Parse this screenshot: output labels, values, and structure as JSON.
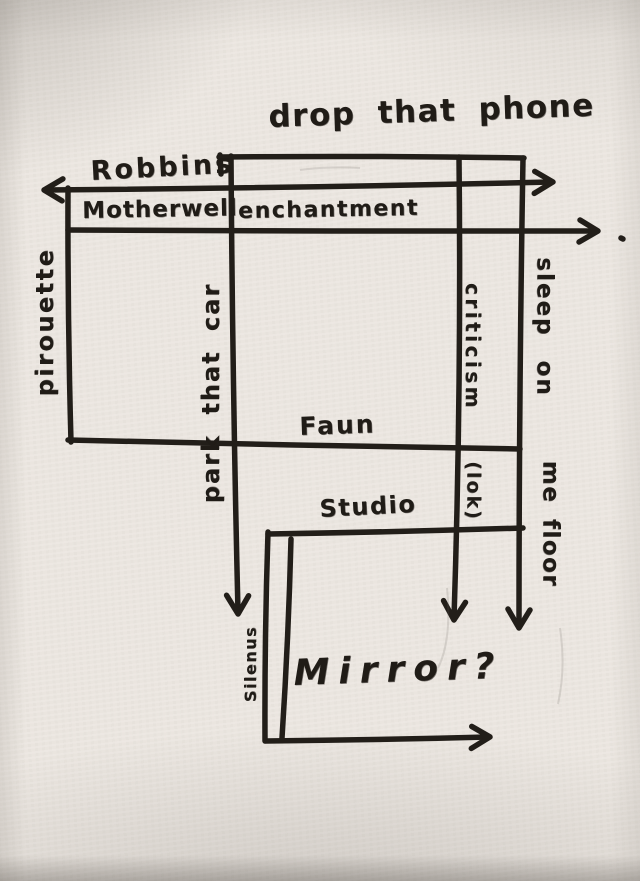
{
  "colors": {
    "paper": "#eae5df",
    "ink": "#221e19"
  },
  "diagram": {
    "labels": [
      {
        "name": "drop-that-phone",
        "text": "drop that phone",
        "x": 268,
        "y": 102,
        "size": 31,
        "rotate": -2,
        "spacing": 1.5,
        "word": 10
      },
      {
        "name": "robbins",
        "text": "Robbins",
        "x": 90,
        "y": 158,
        "size": 27,
        "rotate": -3,
        "spacing": 3,
        "word": 0
      },
      {
        "name": "motherwell",
        "text": "Motherwell",
        "x": 82,
        "y": 200,
        "size": 23,
        "rotate": -1,
        "spacing": 1,
        "word": 0
      },
      {
        "name": "enchantment",
        "text": "enchantment",
        "x": 238,
        "y": 201,
        "size": 22,
        "rotate": -1,
        "spacing": 1.5,
        "word": 0
      },
      {
        "name": "faun",
        "text": "Faun",
        "x": 299,
        "y": 414,
        "size": 25,
        "rotate": -2,
        "spacing": 2,
        "word": 0
      },
      {
        "name": "studio",
        "text": "Studio",
        "x": 319,
        "y": 497,
        "size": 24,
        "rotate": -3,
        "spacing": 1.5,
        "word": 0
      },
      {
        "name": "mirror",
        "text": "Mirror?",
        "x": 293,
        "y": 656,
        "size": 36,
        "rotate": -2,
        "spacing": 9,
        "word": 0,
        "italic": true
      },
      {
        "name": "pirouette",
        "text": "pirouette",
        "cx": 45,
        "cy": 322,
        "size": 24,
        "vertical": "up",
        "spacing": 2.5,
        "word": 0
      },
      {
        "name": "park-that-car",
        "text": "park that car",
        "cx": 211,
        "cy": 393,
        "size": 24,
        "vertical": "up",
        "spacing": 2,
        "word": 9
      },
      {
        "name": "criticism",
        "text": "criticism",
        "cx": 473,
        "cy": 347,
        "size": 20,
        "vertical": "down",
        "spacing": 3.5,
        "word": 0
      },
      {
        "name": "sleep-on",
        "text": "sleep on",
        "cx": 544,
        "cy": 327,
        "size": 23,
        "vertical": "down",
        "spacing": 2,
        "word": 14
      },
      {
        "name": "me-floor",
        "text": "me floor",
        "cx": 550,
        "cy": 524,
        "size": 23,
        "vertical": "down",
        "spacing": 1.5,
        "word": 6
      },
      {
        "name": "lok",
        "text": "(lok)",
        "cx": 473,
        "cy": 491,
        "size": 19,
        "vertical": "down",
        "spacing": 2,
        "word": 0
      },
      {
        "name": "silenus",
        "text": "Silenus",
        "cx": 251,
        "cy": 664,
        "size": 16,
        "vertical": "up",
        "spacing": 1.5,
        "word": 0
      }
    ],
    "strokes": [
      {
        "name": "top-line",
        "x1": 219,
        "y1": 157,
        "x2": 524,
        "y2": 158,
        "bow": -2
      },
      {
        "name": "top-line-left-tick",
        "x1": 220,
        "y1": 155,
        "x2": 221,
        "y2": 174,
        "bow": 0
      },
      {
        "name": "robbins-line",
        "x1": 46,
        "y1": 190,
        "x2": 551,
        "y2": 182,
        "bow": 2,
        "startArrow": true,
        "endArrow": true
      },
      {
        "name": "motherwell-line",
        "x1": 68,
        "y1": 230,
        "x2": 596,
        "y2": 231,
        "bow": 1,
        "endArrow": true
      },
      {
        "name": "motherwell-arrow-dot",
        "x1": 621,
        "y1": 238,
        "x2": 623,
        "y2": 239,
        "bow": 0
      },
      {
        "name": "left-vertical",
        "x1": 68,
        "y1": 188,
        "x2": 71,
        "y2": 442,
        "bow": 2
      },
      {
        "name": "park-vertical",
        "x1": 231,
        "y1": 156,
        "x2": 238,
        "y2": 612,
        "bow": 2,
        "endArrow": true
      },
      {
        "name": "criticism-vertical",
        "x1": 459,
        "y1": 157,
        "x2": 454,
        "y2": 618,
        "bow": -5,
        "endArrow": true
      },
      {
        "name": "sleep-vertical",
        "x1": 523,
        "y1": 158,
        "x2": 519,
        "y2": 626,
        "bow": 2,
        "endArrow": true
      },
      {
        "name": "faun-line",
        "x1": 68,
        "y1": 440,
        "x2": 520,
        "y2": 449,
        "bow": 1
      },
      {
        "name": "studio-line",
        "x1": 268,
        "y1": 534,
        "x2": 523,
        "y2": 528,
        "bow": 1
      },
      {
        "name": "silenus-left-vertical",
        "x1": 268,
        "y1": 532,
        "x2": 265,
        "y2": 741,
        "bow": 2
      },
      {
        "name": "mirror-left-vertical",
        "x1": 291,
        "y1": 539,
        "x2": 282,
        "y2": 738,
        "bow": -2
      },
      {
        "name": "mirror-bottom-line",
        "x1": 266,
        "y1": 741,
        "x2": 488,
        "y2": 737,
        "bow": 1,
        "endArrow": true
      }
    ],
    "smudges": [
      {
        "name": "smudge-1",
        "d": "M447 588 Q452 640 438 668"
      },
      {
        "name": "smudge-2",
        "d": "M560 628 Q566 668 558 704"
      },
      {
        "name": "smudge-3",
        "d": "M300 170 Q330 166 360 168"
      }
    ]
  }
}
